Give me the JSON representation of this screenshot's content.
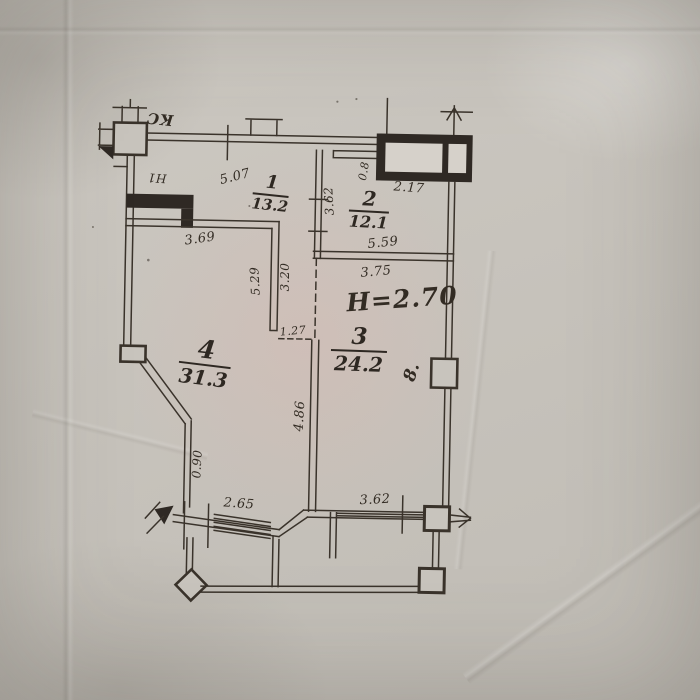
{
  "plan": {
    "annotations": {
      "corner_mark": "КС",
      "wall_mark": "Н1",
      "ceiling_height": "H=2.70",
      "scribble": "8."
    },
    "rooms": [
      {
        "number": "1",
        "area": "13.2"
      },
      {
        "number": "2",
        "area": "12.1"
      },
      {
        "number": "3",
        "area": "24.2"
      },
      {
        "number": "4",
        "area": "31.3"
      }
    ],
    "dimensions": {
      "top_width": "5.07",
      "window_width": "2.17",
      "window_offset": "0.8",
      "room2_width": "5.59",
      "room2_height": "3.62",
      "room3_width": "3.75",
      "room4_width": "3.69",
      "wall_upper": "5.29",
      "wall_lower": "3.20",
      "opening": "1.27",
      "partition_height": "4.86",
      "left_offset": "0.90",
      "bottom_left_width": "2.65",
      "bottom_right_width": "3.62"
    },
    "colors": {
      "ink": "#332c24",
      "paper": "#c7c3bc",
      "tint": "#e0c8c2"
    }
  }
}
